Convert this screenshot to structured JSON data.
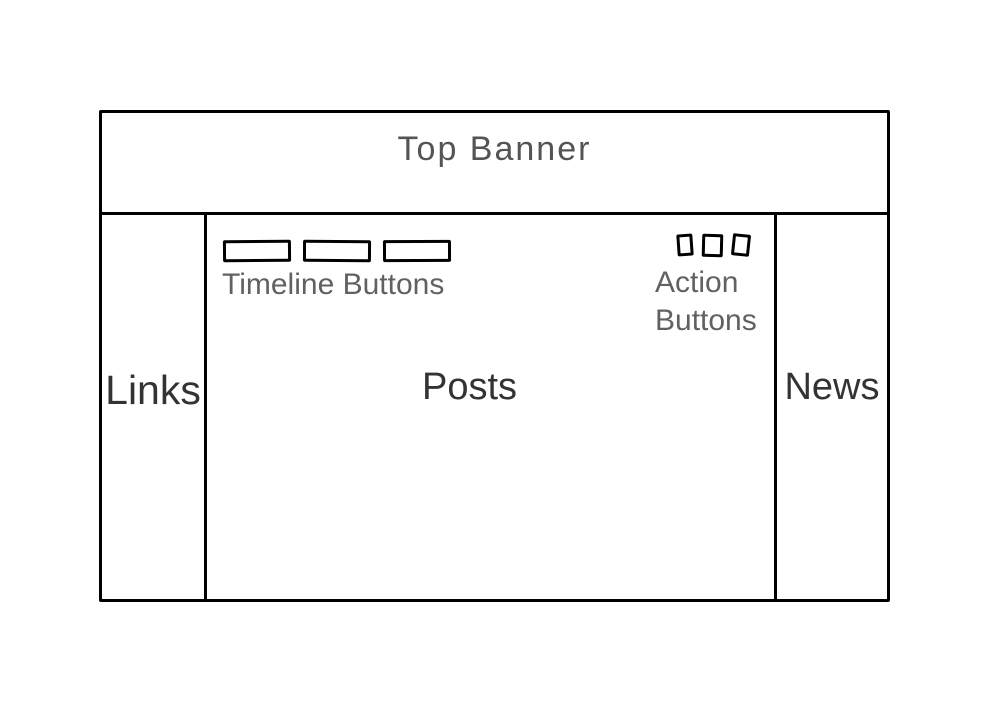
{
  "page": {
    "background": "#ffffff"
  },
  "colors": {
    "border": "#000000",
    "banner_text": "#545454",
    "section_text": "#333333",
    "hint_text": "#616161"
  },
  "wireframe": {
    "banner": {
      "label": "Top Banner"
    },
    "left_sidebar": {
      "label": "Links"
    },
    "main": {
      "label": "Posts",
      "timeline_buttons": {
        "label": "Timeline Buttons",
        "count": 3
      },
      "action_buttons": {
        "label": "Action Buttons",
        "count": 3
      }
    },
    "right_sidebar": {
      "label": "News"
    }
  }
}
